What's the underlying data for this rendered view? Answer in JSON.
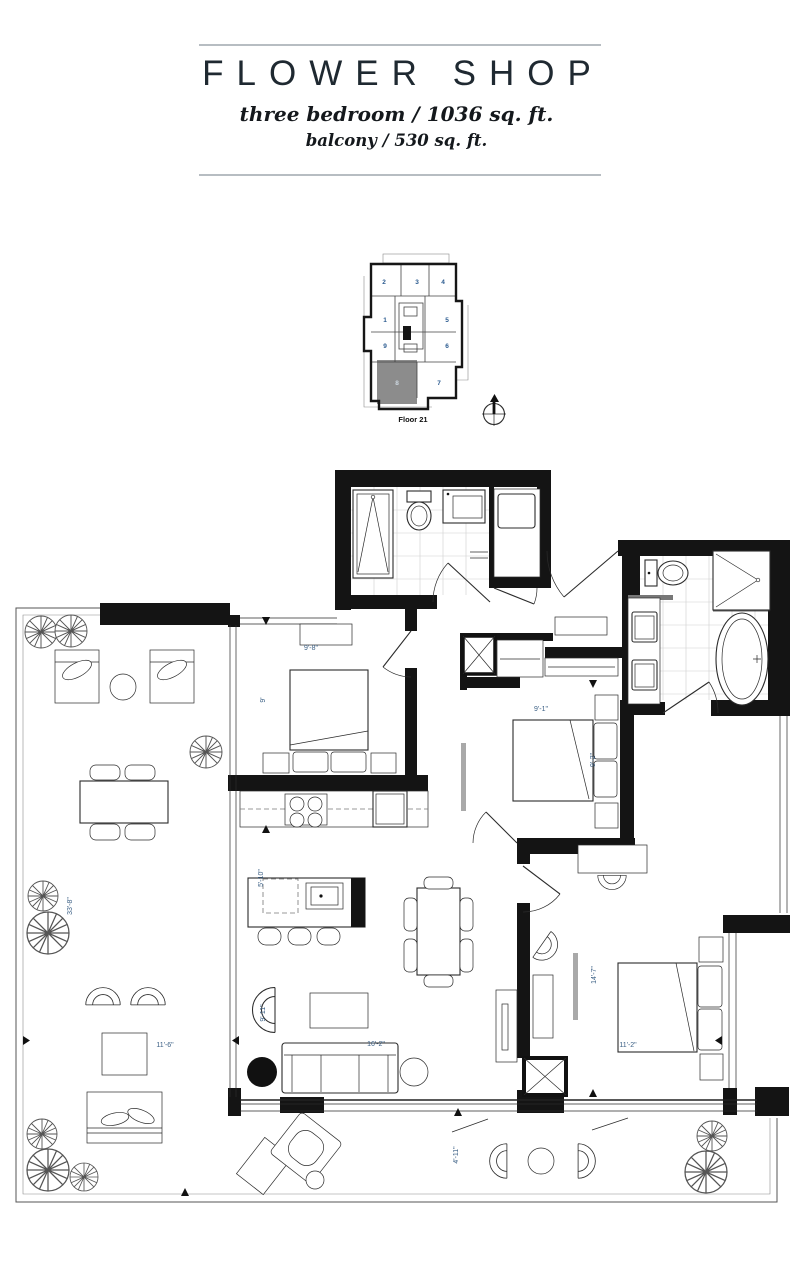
{
  "header": {
    "title": "FLOWER SHOP",
    "subtitle1": "three bedroom / 1036 sq. ft.",
    "subtitle2": "balcony / 530 sq. ft."
  },
  "keyplan": {
    "floor_label": "Floor 21",
    "units": [
      "1",
      "2",
      "3",
      "4",
      "5",
      "6",
      "7",
      "8",
      "9"
    ],
    "highlighted_unit": "8",
    "highlight_fill": "#8c8c8c",
    "unit_number_color": "#2a5a8f"
  },
  "icons": {
    "compass": "compass-north-icon"
  },
  "plan": {
    "dimensions": {
      "bedroom2_width": "9'-8\"",
      "bedroom2_depth": "9'",
      "bedroom3_width": "9'-1\"",
      "bedroom3_depth": "9'-2\"",
      "master_depth": "14'-7\"",
      "master_width": "11'-2\"",
      "living_width": "16'-2\"",
      "living_depth": "9'-11\"",
      "island_length": "5'-10\"",
      "balcony_length": "33'-8\"",
      "balcony_width": "11'-6\"",
      "balcony_depth": "4'-11\""
    },
    "colors": {
      "dimension_text": "#3d6186",
      "wall": "#141414"
    }
  }
}
